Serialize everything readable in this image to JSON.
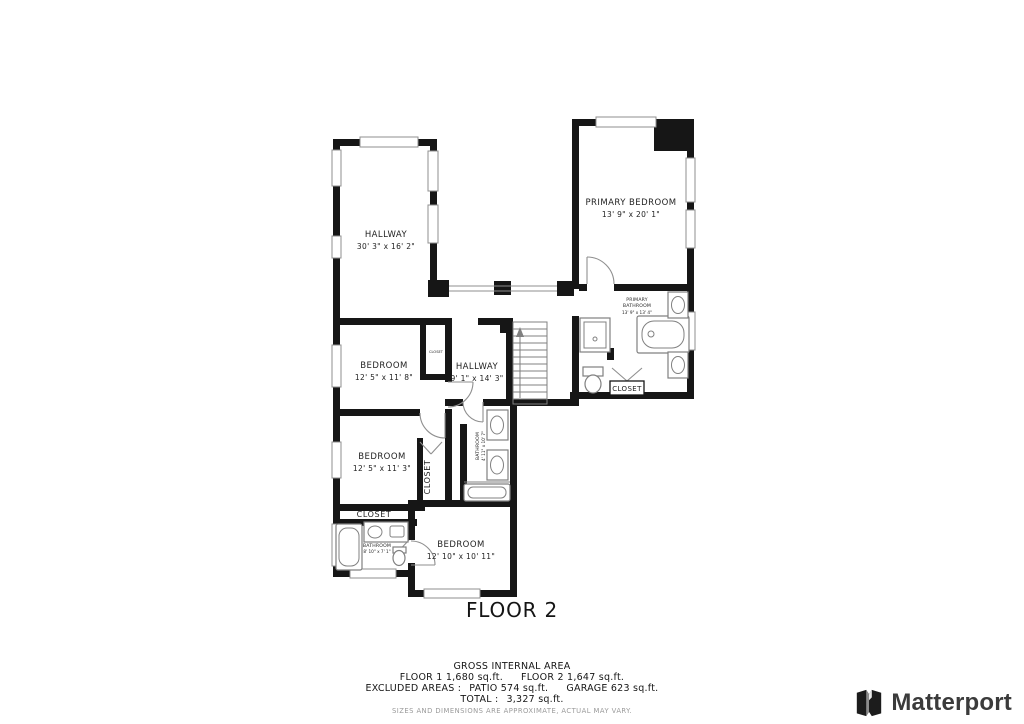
{
  "floor_label": "FLOOR 2",
  "rooms": {
    "hallway_large": {
      "name": "HALLWAY",
      "dims": "30' 3\" x 16' 2\""
    },
    "primary_bedroom": {
      "name": "PRIMARY BEDROOM",
      "dims": "13' 9\" x 20' 1\""
    },
    "bedroom_1": {
      "name": "BEDROOM",
      "dims": "12' 5\" x 11' 8\""
    },
    "hallway_small": {
      "name": "HALLWAY",
      "dims": "9' 1\" x 14' 3\""
    },
    "bedroom_2": {
      "name": "BEDROOM",
      "dims": "12' 5\" x 11' 3\""
    },
    "bedroom_3": {
      "name": "BEDROOM",
      "dims": "12' 10\" x 10' 11\""
    },
    "primary_bathroom": {
      "line1": "PRIMARY",
      "line2": "BATHROOM",
      "dims": "13' 9\" x 13' 4\""
    },
    "hall_bathroom": {
      "name": "BATHROOM",
      "dims": "4' 11\" x 10' 7\""
    },
    "left_bathroom": {
      "name": "BATHROOM",
      "dims": "8' 10\" x 7' 1\""
    },
    "closets": {
      "primary": "CLOSET",
      "bedroom2": "CLOSET",
      "hall": "CLOSET",
      "bedroom1": "CLOSET"
    }
  },
  "summary": {
    "title": "GROSS INTERNAL AREA",
    "floor1": "FLOOR 1 1,680 sq.ft.",
    "floor2": "FLOOR 2 1,647 sq.ft.",
    "excluded": "EXCLUDED AREAS :",
    "patio": "PATIO 574 sq.ft.",
    "garage": "GARAGE 623 sq.ft.",
    "total_label": "TOTAL :",
    "total_value": "3,327 sq.ft.",
    "disclaimer": "SIZES AND DIMENSIONS ARE APPROXIMATE, ACTUAL MAY VARY."
  },
  "branding": {
    "name": "Matterport"
  },
  "colors": {
    "wall": "#161616",
    "line": "#8f8f8f",
    "text": "#232323",
    "muted": "#9a9a9a",
    "brand_text": "#3b3b3b"
  }
}
